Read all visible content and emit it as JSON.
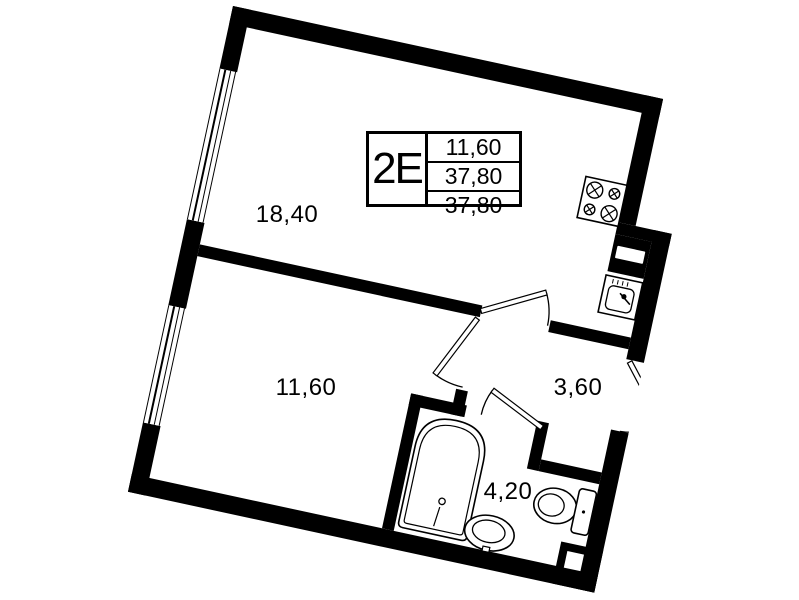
{
  "unit_card": {
    "type_label": "2E",
    "areas": [
      "11,60",
      "37,80",
      "37,80"
    ]
  },
  "rooms": {
    "living_kitchen": {
      "area": "18,40"
    },
    "bedroom": {
      "area": "11,60"
    },
    "hallway": {
      "area": "3,60"
    },
    "bathroom": {
      "area": "4,20"
    }
  },
  "fixtures": [
    "stove",
    "kitchen-sink",
    "ventilation-shaft",
    "bathtub",
    "washbasin",
    "toilet"
  ],
  "doors": [
    "living-room-door",
    "bedroom-door",
    "bathroom-door",
    "entrance-door"
  ],
  "windows": [
    "window-upper",
    "window-lower"
  ],
  "colors": {
    "wall": "#000000",
    "background": "#ffffff"
  }
}
